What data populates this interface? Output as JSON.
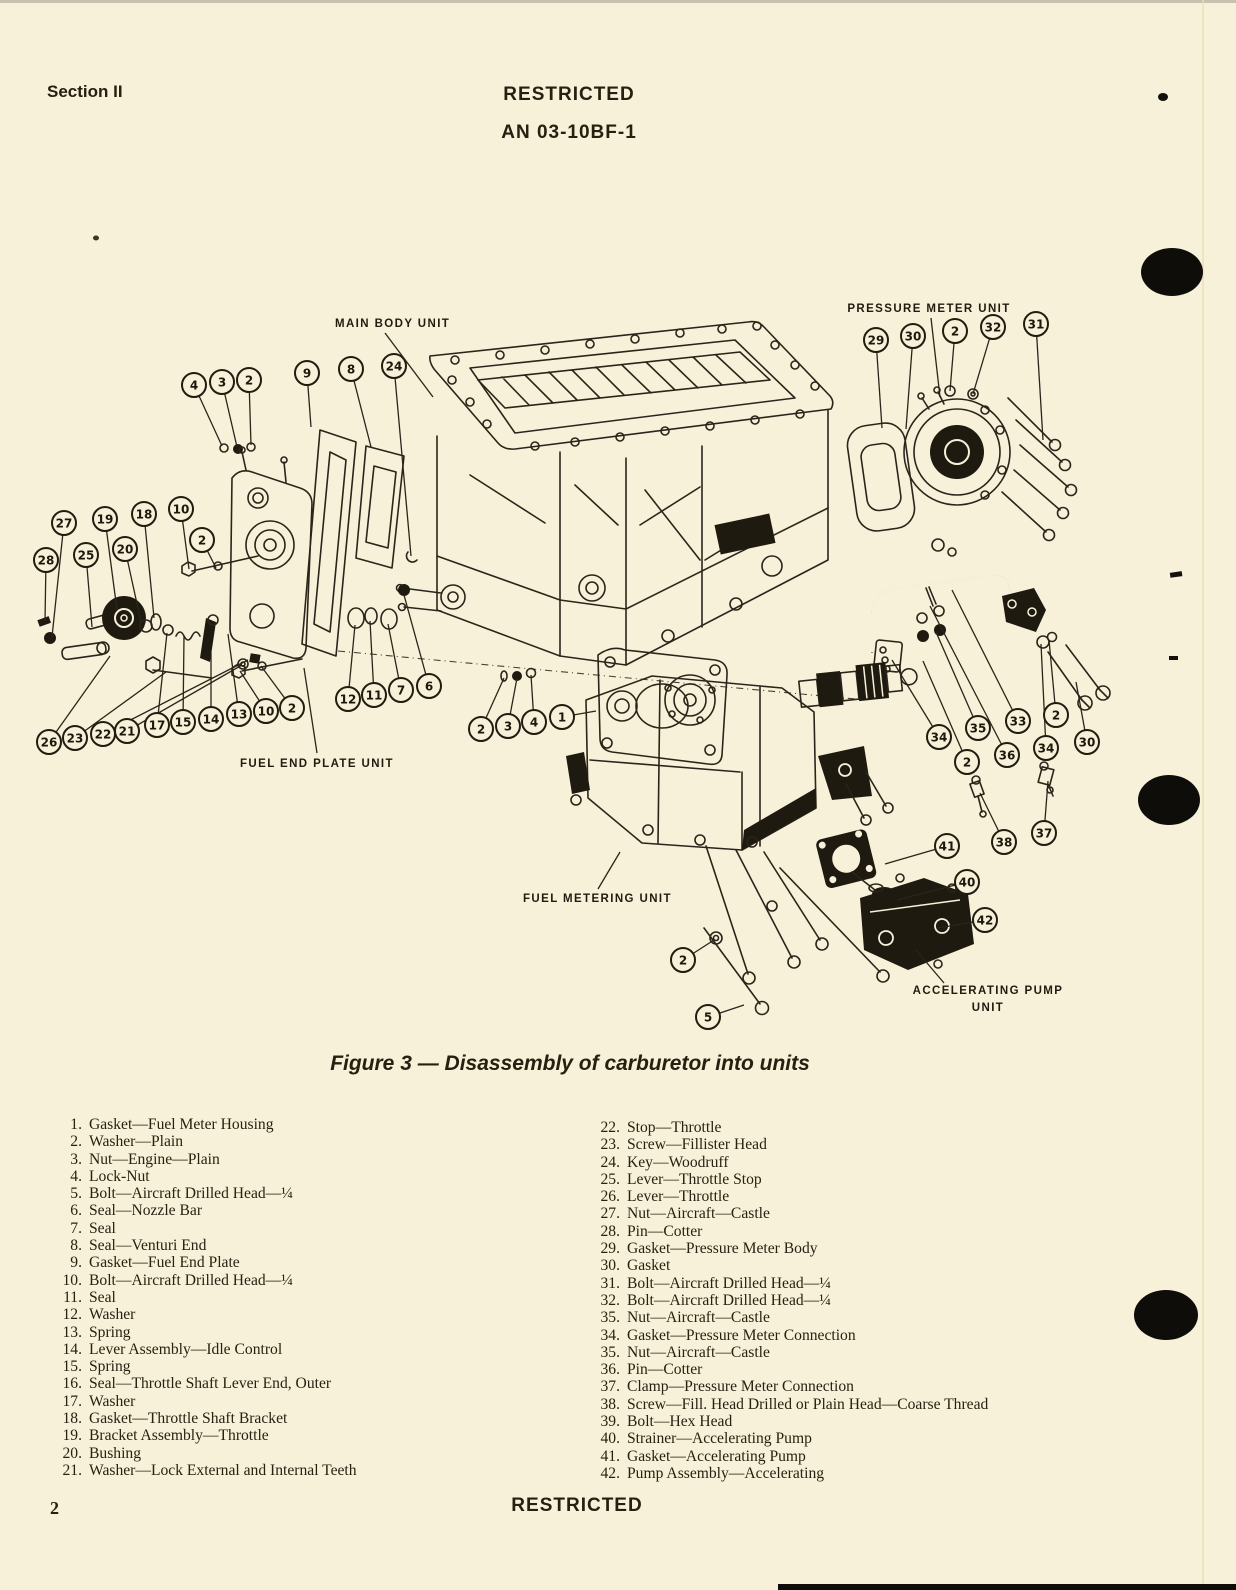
{
  "header": {
    "section": "Section II",
    "restricted": "RESTRICTED",
    "doc_number": "AN 03-10BF-1"
  },
  "figure_caption": "Figure 3 — Disassembly of carburetor into units",
  "footer": {
    "page_number": "2",
    "restricted": "RESTRICTED"
  },
  "diagram": {
    "unit_labels": [
      {
        "text": "MAIN BODY UNIT",
        "x": 335,
        "y": 327,
        "anchor": "start",
        "leader": [
          385,
          333,
          433,
          397
        ]
      },
      {
        "text": "PRESSURE METER UNIT",
        "x": 929,
        "y": 312,
        "anchor": "middle",
        "leader": [
          931,
          318,
          940,
          397
        ]
      },
      {
        "text": "FUEL END PLATE UNIT",
        "x": 240,
        "y": 767,
        "anchor": "start",
        "leader": [
          317,
          753,
          304,
          668
        ]
      },
      {
        "text": "FUEL METERING UNIT",
        "x": 523,
        "y": 902,
        "anchor": "start",
        "leader": [
          598,
          889,
          620,
          852
        ]
      },
      {
        "text": "ACCELERATING PUMP",
        "x": 988,
        "y": 994,
        "anchor": "middle",
        "leader": [
          944,
          983,
          916,
          950
        ]
      },
      {
        "text": "UNIT",
        "x": 988,
        "y": 1011,
        "anchor": "middle",
        "leader": null
      }
    ],
    "callouts": [
      {
        "n": "4",
        "x": 194,
        "y": 385,
        "tx": 222,
        "ty": 446
      },
      {
        "n": "3",
        "x": 222,
        "y": 382,
        "tx": 237,
        "ty": 447
      },
      {
        "n": "2",
        "x": 249,
        "y": 380,
        "tx": 251,
        "ty": 445
      },
      {
        "n": "9",
        "x": 307,
        "y": 373,
        "tx": 311,
        "ty": 427
      },
      {
        "n": "8",
        "x": 351,
        "y": 369,
        "tx": 371,
        "ty": 447
      },
      {
        "n": "24",
        "x": 394,
        "y": 366,
        "tx": 411,
        "ty": 556
      },
      {
        "n": "29",
        "x": 876,
        "y": 340,
        "tx": 882,
        "ty": 428
      },
      {
        "n": "30",
        "x": 913,
        "y": 336,
        "tx": 906,
        "ty": 429
      },
      {
        "n": "2",
        "x": 955,
        "y": 331,
        "tx": 950,
        "ty": 391
      },
      {
        "n": "32",
        "x": 993,
        "y": 327,
        "tx": 973,
        "ty": 394
      },
      {
        "n": "31",
        "x": 1036,
        "y": 324,
        "tx": 1043,
        "ty": 440
      },
      {
        "n": "28",
        "x": 46,
        "y": 560,
        "tx": 45,
        "ty": 621
      },
      {
        "n": "27",
        "x": 64,
        "y": 523,
        "tx": 52,
        "ty": 637
      },
      {
        "n": "25",
        "x": 86,
        "y": 555,
        "tx": 92,
        "ty": 627
      },
      {
        "n": "19",
        "x": 105,
        "y": 519,
        "tx": 117,
        "ty": 610
      },
      {
        "n": "20",
        "x": 125,
        "y": 549,
        "tx": 141,
        "ty": 622
      },
      {
        "n": "18",
        "x": 144,
        "y": 514,
        "tx": 154,
        "ty": 618
      },
      {
        "n": "10",
        "x": 181,
        "y": 509,
        "tx": 189,
        "ty": 569
      },
      {
        "n": "2",
        "x": 202,
        "y": 540,
        "tx": 216,
        "ty": 568
      },
      {
        "n": "26",
        "x": 49,
        "y": 742,
        "tx": 110,
        "ty": 656
      },
      {
        "n": "23",
        "x": 75,
        "y": 738,
        "tx": 166,
        "ty": 672
      },
      {
        "n": "22",
        "x": 103,
        "y": 734,
        "tx": 248,
        "ty": 660
      },
      {
        "n": "21",
        "x": 127,
        "y": 731,
        "tx": 242,
        "ty": 665
      },
      {
        "n": "17",
        "x": 157,
        "y": 725,
        "tx": 167,
        "ty": 633
      },
      {
        "n": "15",
        "x": 183,
        "y": 722,
        "tx": 184,
        "ty": 636
      },
      {
        "n": "14",
        "x": 211,
        "y": 719,
        "tx": 211,
        "ty": 652
      },
      {
        "n": "13",
        "x": 239,
        "y": 714,
        "tx": 228,
        "ty": 634
      },
      {
        "n": "10",
        "x": 266,
        "y": 711,
        "tx": 240,
        "ty": 671
      },
      {
        "n": "2",
        "x": 292,
        "y": 708,
        "tx": 261,
        "ty": 666
      },
      {
        "n": "12",
        "x": 348,
        "y": 699,
        "tx": 355,
        "ty": 625
      },
      {
        "n": "11",
        "x": 374,
        "y": 695,
        "tx": 370,
        "ty": 621
      },
      {
        "n": "7",
        "x": 401,
        "y": 690,
        "tx": 388,
        "ty": 624
      },
      {
        "n": "6",
        "x": 429,
        "y": 686,
        "tx": 404,
        "ty": 595
      },
      {
        "n": "2",
        "x": 481,
        "y": 729,
        "tx": 504,
        "ty": 678
      },
      {
        "n": "3",
        "x": 508,
        "y": 726,
        "tx": 517,
        "ty": 678
      },
      {
        "n": "4",
        "x": 534,
        "y": 722,
        "tx": 531,
        "ty": 675
      },
      {
        "n": "1",
        "x": 562,
        "y": 717,
        "tx": 596,
        "ty": 711
      },
      {
        "n": "34",
        "x": 939,
        "y": 737,
        "tx": 892,
        "ty": 660
      },
      {
        "n": "2",
        "x": 967,
        "y": 762,
        "tx": 923,
        "ty": 661
      },
      {
        "n": "35",
        "x": 978,
        "y": 728,
        "tx": 936,
        "ty": 632
      },
      {
        "n": "36",
        "x": 1007,
        "y": 755,
        "tx": 930,
        "ty": 606
      },
      {
        "n": "33",
        "x": 1018,
        "y": 721,
        "tx": 952,
        "ty": 590
      },
      {
        "n": "34",
        "x": 1046,
        "y": 748,
        "tx": 1041,
        "ty": 644
      },
      {
        "n": "2",
        "x": 1056,
        "y": 715,
        "tx": 1049,
        "ty": 640
      },
      {
        "n": "30",
        "x": 1087,
        "y": 742,
        "tx": 1076,
        "ty": 682
      },
      {
        "n": "41",
        "x": 947,
        "y": 846,
        "tx": 885,
        "ty": 864
      },
      {
        "n": "40",
        "x": 967,
        "y": 882,
        "tx": 897,
        "ty": 900
      },
      {
        "n": "42",
        "x": 985,
        "y": 920,
        "tx": 938,
        "ty": 928
      },
      {
        "n": "38",
        "x": 1004,
        "y": 842,
        "tx": 980,
        "ty": 793
      },
      {
        "n": "37",
        "x": 1044,
        "y": 833,
        "tx": 1048,
        "ty": 781
      },
      {
        "n": "2",
        "x": 683,
        "y": 960,
        "tx": 714,
        "ty": 940
      },
      {
        "n": "5",
        "x": 708,
        "y": 1017,
        "tx": 744,
        "ty": 1005
      }
    ]
  },
  "parts_list": {
    "left": [
      {
        "num": "1.",
        "text": "Gasket—Fuel Meter Housing"
      },
      {
        "num": "2.",
        "text": "Washer—Plain"
      },
      {
        "num": "3.",
        "text": "Nut—Engine—Plain"
      },
      {
        "num": "4.",
        "text": "Lock-Nut"
      },
      {
        "num": "5.",
        "text": "Bolt—Aircraft Drilled Head—¼"
      },
      {
        "num": "6.",
        "text": "Seal—Nozzle Bar"
      },
      {
        "num": "7.",
        "text": "Seal"
      },
      {
        "num": "8.",
        "text": "Seal—Venturi End"
      },
      {
        "num": "9.",
        "text": "Gasket—Fuel End Plate"
      },
      {
        "num": "10.",
        "text": "Bolt—Aircraft Drilled Head—¼"
      },
      {
        "num": "11.",
        "text": "Seal"
      },
      {
        "num": "12.",
        "text": "Washer"
      },
      {
        "num": "13.",
        "text": "Spring"
      },
      {
        "num": "14.",
        "text": "Lever Assembly—Idle Control"
      },
      {
        "num": "15.",
        "text": "Spring"
      },
      {
        "num": "16.",
        "text": "Seal—Throttle Shaft Lever End, Outer"
      },
      {
        "num": "17.",
        "text": "Washer"
      },
      {
        "num": "18.",
        "text": "Gasket—Throttle Shaft Bracket"
      },
      {
        "num": "19.",
        "text": "Bracket Assembly—Throttle"
      },
      {
        "num": "20.",
        "text": "Bushing"
      },
      {
        "num": "21.",
        "text": "Washer—Lock External and Internal Teeth"
      }
    ],
    "right": [
      {
        "num": "22.",
        "text": "Stop—Throttle"
      },
      {
        "num": "23.",
        "text": "Screw—Fillister Head"
      },
      {
        "num": "24.",
        "text": "Key—Woodruff"
      },
      {
        "num": "25.",
        "text": "Lever—Throttle Stop"
      },
      {
        "num": "26.",
        "text": "Lever—Throttle"
      },
      {
        "num": "27.",
        "text": "Nut—Aircraft—Castle"
      },
      {
        "num": "28.",
        "text": "Pin—Cotter"
      },
      {
        "num": "29.",
        "text": "Gasket—Pressure Meter Body"
      },
      {
        "num": "30.",
        "text": "Gasket"
      },
      {
        "num": "31.",
        "text": "Bolt—Aircraft Drilled Head—¼"
      },
      {
        "num": "32.",
        "text": "Bolt—Aircraft Drilled Head—¼"
      },
      {
        "num": "35.",
        "text": "Nut—Aircraft—Castle"
      },
      {
        "num": "34.",
        "text": "Gasket—Pressure Meter Connection"
      },
      {
        "num": "35.",
        "text": "Nut—Aircraft—Castle"
      },
      {
        "num": "36.",
        "text": "Pin—Cotter"
      },
      {
        "num": "37.",
        "text": "Clamp—Pressure Meter Connection"
      },
      {
        "num": "38.",
        "text": "Screw—Fill. Head Drilled or Plain Head—Coarse Thread"
      },
      {
        "num": "39.",
        "text": "Bolt—Hex Head"
      },
      {
        "num": "40.",
        "text": "Strainer—Accelerating Pump"
      },
      {
        "num": "41.",
        "text": "Gasket—Accelerating Pump"
      },
      {
        "num": "42.",
        "text": "Pump Assembly—Accelerating"
      }
    ]
  }
}
